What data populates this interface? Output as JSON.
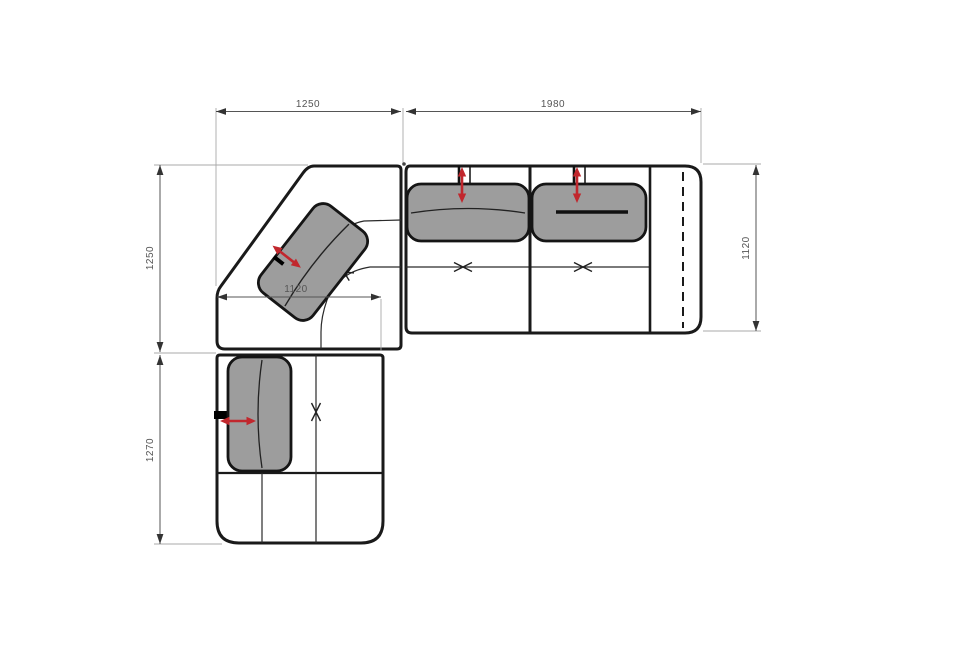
{
  "diagram": {
    "type": "furniture-plan",
    "subject": "corner-sectional-sofa-top-view",
    "dimensions": {
      "top_left": {
        "value": "1250",
        "orientation": "horizontal",
        "edge": "top, corner section width"
      },
      "top_right": {
        "value": "1980",
        "orientation": "horizontal",
        "edge": "top, right sofa section width"
      },
      "left_upper": {
        "value": "1250",
        "orientation": "vertical",
        "edge": "left, corner section height"
      },
      "left_lower": {
        "value": "1270",
        "orientation": "vertical",
        "edge": "left, chaise section height"
      },
      "right_side": {
        "value": "1120",
        "orientation": "vertical",
        "edge": "right, sofa depth"
      },
      "corner_inner": {
        "value": "1120",
        "orientation": "horizontal",
        "edge": "inner, chaise section width"
      }
    },
    "colors": {
      "outline": "#1a1a1a",
      "cushion_fill": "#9d9d9d",
      "arrow_red": "#c1272d",
      "dimension_line": "#555555",
      "extension_line": "#a8a8a8",
      "background": "#ffffff"
    }
  }
}
